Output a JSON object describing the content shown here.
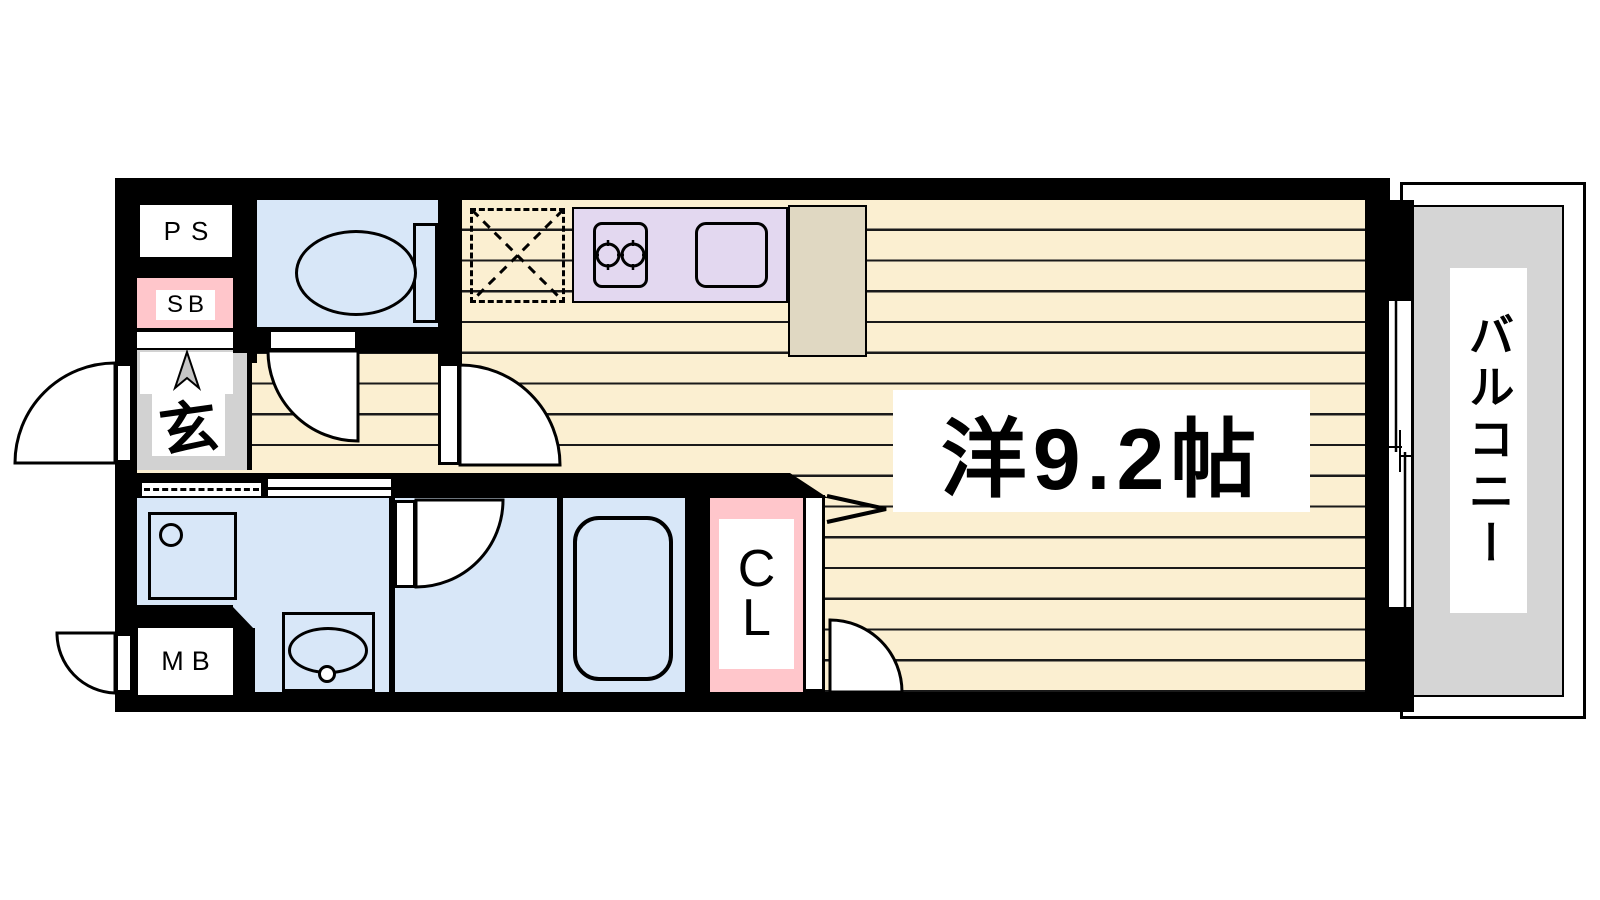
{
  "floorplan": {
    "labels": {
      "pipe_space": "PS",
      "shaft_box": "SB",
      "entrance": "玄",
      "meter_box": "MB",
      "closet_line1": "C",
      "closet_line2": "L",
      "main_room": "洋9.2帖",
      "balcony": "バルコニー"
    },
    "colors": {
      "wall": "#000000",
      "floor": "#FBEFD1",
      "line": "#1A1A1A",
      "water": "#D8E7F8",
      "counter": "#E3D8F0",
      "pink": "#FFC6CB",
      "tan": "#E0D8C2",
      "entry": "#D2D2D2",
      "balcony": "#D5D5D5",
      "label": "#FFFFFF",
      "marker": "#C6C6C6"
    },
    "features": [
      "toilet",
      "kitchen-stove",
      "kitchen-sink",
      "refrigerator-space",
      "kitchen-cabinet",
      "washing-machine-pan",
      "vanity-sink",
      "bathtub",
      "closet",
      "entrance-door",
      "meter-box-door",
      "sliding-window",
      "balcony"
    ]
  }
}
